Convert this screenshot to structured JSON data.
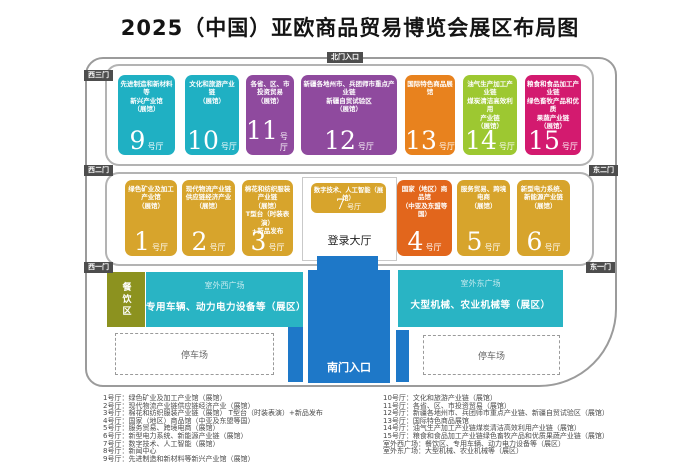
{
  "title": "2025（中国）亚欧商品贸易博览会展区布局图",
  "gates": {
    "north": "北门入口",
    "west3": "西三门",
    "west2": "西二门",
    "west1": "西一门",
    "east2": "东二门",
    "east1": "东一门",
    "south": "南门入口"
  },
  "halls": {
    "h1": {
      "number": "1",
      "suffix": "号厅",
      "name": "绿色矿业及加工\n产业馆\n（展馆）"
    },
    "h2": {
      "number": "2",
      "suffix": "号厅",
      "name": "现代物流产业链\n供应链经济产业\n（展馆）"
    },
    "h3": {
      "number": "3",
      "suffix": "号厅",
      "name": "棉花和纺织服装产业链\n（展馆）\nT型台（时装表演）\n+新品发布"
    },
    "h4": {
      "number": "4",
      "suffix": "号厅",
      "name": "国家（地区）商品馆\n（中亚及东盟等国）"
    },
    "h5": {
      "number": "5",
      "suffix": "号厅",
      "name": "服务贸易、跨境电商\n（展馆）"
    },
    "h6": {
      "number": "6",
      "suffix": "号厅",
      "name": "新型电力系统、\n新能源产业链\n（展馆）"
    },
    "h7": {
      "number": "7",
      "suffix": "号厅",
      "name": "数字技术、人工智能（展馆）"
    },
    "h9": {
      "number": "9",
      "suffix": "号厅",
      "name": "先进制造和新材料等\n新兴产业馆\n（展馆）"
    },
    "h10": {
      "number": "10",
      "suffix": "号厅",
      "name": "文化和旅游产业链\n（展馆）"
    },
    "h11": {
      "number": "11",
      "suffix": "号厅",
      "name": "各省、区、市\n投资贸易\n（展馆）"
    },
    "h12": {
      "number": "12",
      "suffix": "号厅",
      "name": "新疆各地州市、兵团师市重点产业链\n新疆自贸试验区\n（展馆）"
    },
    "h13": {
      "number": "13",
      "suffix": "号厅",
      "name": "国际特色商品展馆"
    },
    "h14": {
      "number": "14",
      "suffix": "号厅",
      "name": "油气生产加工产业链\n煤炭清洁高效利用\n产业链\n（展馆）"
    },
    "h15": {
      "number": "15",
      "suffix": "号厅",
      "name": "粮食和食品加工产业链\n绿色畜牧产品和优质\n果蔬产业链\n（展馆）"
    }
  },
  "center": {
    "lobby": "登录大厅"
  },
  "outdoor": {
    "dining": "餐饮区",
    "west_plaza": {
      "title": "室外西广场",
      "desc": "专用车辆、动力电力设备等（展区）"
    },
    "east_plaza": {
      "title": "室外东广场",
      "desc": "大型机械、农业机械等（展区）"
    },
    "parking_west": "停车场",
    "parking_east": "停车场"
  },
  "legend": {
    "left": [
      "1号厅：绿色矿业及加工产业馆（展馆）",
      "2号厅：现代物流产业链供应链经济产业（展馆）",
      "3号厅：棉花和纺织服装产业链（展馆） T型台（时装表演）+新品发布",
      "4号厅：国家（地区）商品馆（中亚及东盟等国）",
      "5号厅：服务贸易、跨境电商（展馆）",
      "6号厅：新型电力系统、新能源产业链（展馆）",
      "7号厅：数字技术、人工智能（展馆）",
      "8号厅：新闻中心",
      "9号厅：先进制造和新材料等新兴产业馆（展馆）"
    ],
    "right": [
      "10号厅：文化和旅游产业链（展馆）",
      "11号厅：各省、区、市投资贸易（展馆）",
      "12号厅：新疆各地州市、兵团师市重点产业链、新疆自贸试验区（展馆）",
      "13号厅：国际特色商品展馆",
      "14号厅：油气生产加工产业链煤炭清洁高效利用产业链（展馆）",
      "15号厅：粮食和食品加工产业链绿色畜牧产品和优质果蔬产业链（展馆）",
      "室外西广场：餐饮区、专用车辆、动力电力设备等（展区）",
      "室外东广场：大型机械、农业机械等（展区）"
    ]
  },
  "colors": {
    "teal": "#1fb0c3",
    "purple": "#8f4a9e",
    "orange": "#e8821e",
    "orange_dark": "#e2661c",
    "lime": "#9dc831",
    "magenta": "#d31a6f",
    "gold": "#d7a42c",
    "blue": "#1e78c8",
    "olive": "#8c921f",
    "plaza_teal": "#29b4c4",
    "gate_label_bg": "#4d4d4d"
  }
}
